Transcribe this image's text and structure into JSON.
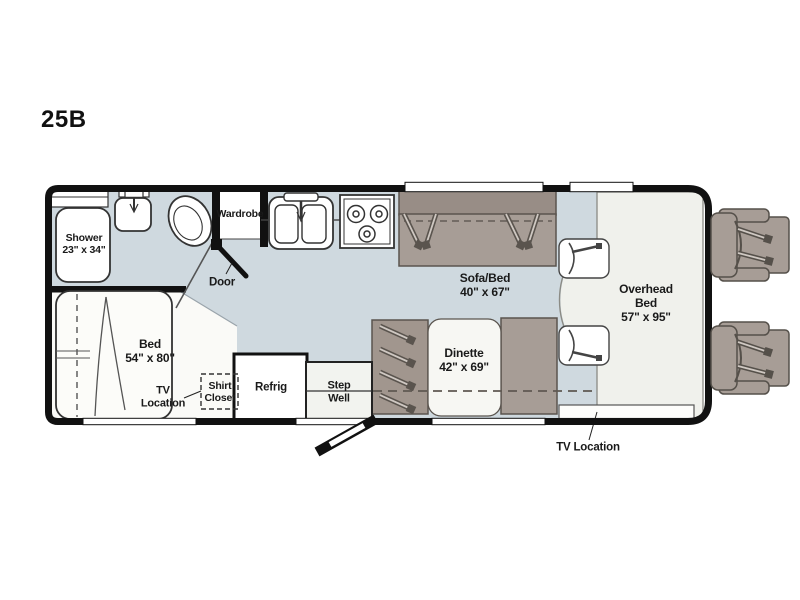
{
  "model_label": "25B",
  "labels": {
    "shower": "Shower\n23\" x 34\"",
    "wardrobe": "Wardrobe",
    "door": "Door",
    "sofa_bed": "Sofa/Bed\n40\" x 67\"",
    "overhead_bed": "Overhead\nBed\n57\" x 95\"",
    "bed": "Bed\n54\" x 80\"",
    "tv_location_bedroom": "TV\nLocation",
    "shirt_closet": "Shirt\nCloset",
    "refrigerator": "Refrig",
    "step_well": "Step\nWell",
    "dinette": "Dinette\n42\" x 69\"",
    "tv_location_front": "TV Location"
  },
  "fixture_icons": [
    "shower-icon",
    "bath-sink-icon",
    "toilet-icon",
    "wardrobe-icon",
    "kitchen-sink-icon",
    "stove-icon",
    "sofa-bed-icon",
    "seatbelt-icon",
    "dinette-icon",
    "refrigerator-icon",
    "step-well-icon",
    "bed-icon",
    "shirt-closet-icon",
    "entry-door-icon",
    "cab-seat-icon",
    "tv-strip-icon",
    "overhead-bed-area"
  ],
  "colors": {
    "wall": "#111111",
    "floor_main": "#cfd9df",
    "floor_bedroom": "#fafaf7",
    "floor_cab": "#f0f1ec",
    "furniture": "#a79d96",
    "furniture_back": "#988d86",
    "furniture_outline": "#5a544e",
    "table_white": "#f7f7f3",
    "label_text": "#1a1a1a",
    "background": "#ffffff"
  }
}
